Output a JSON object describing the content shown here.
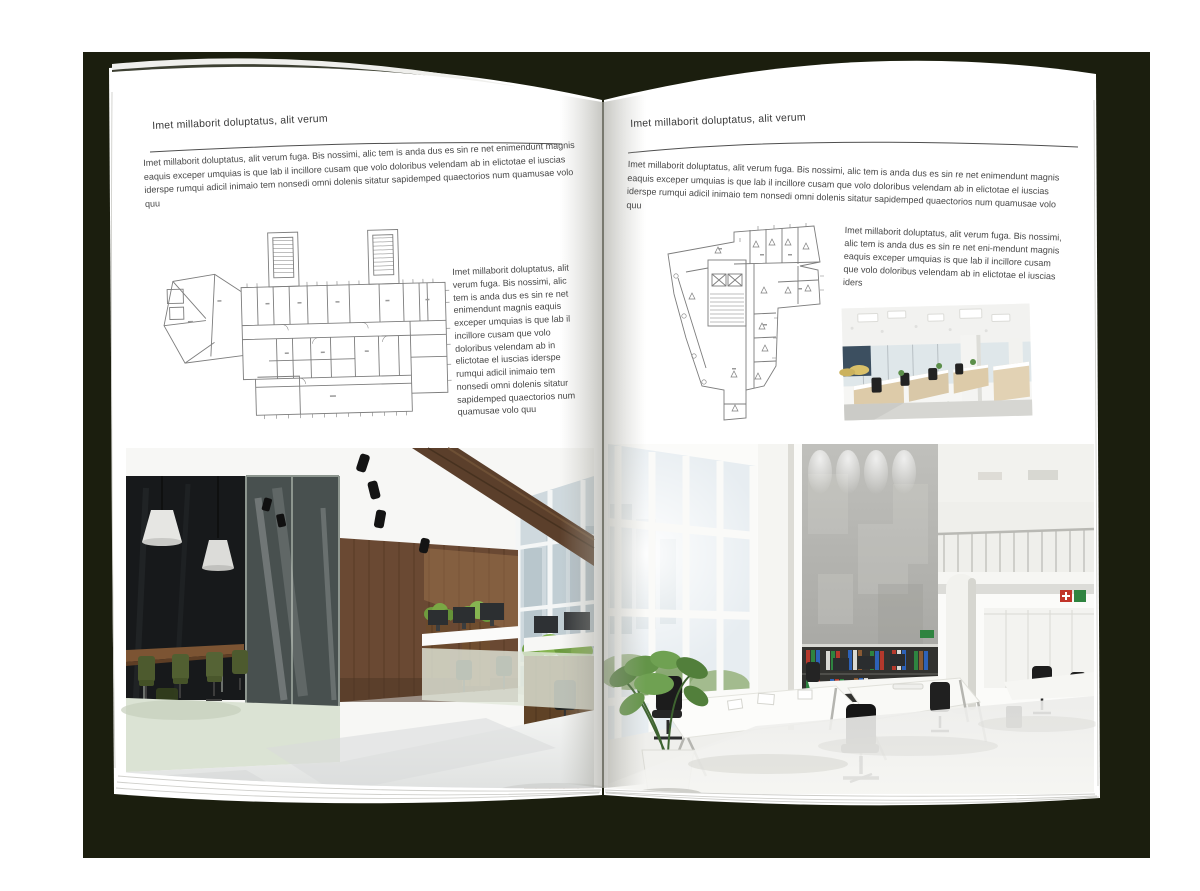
{
  "book": {
    "backdrop_color": "#1b1e0e",
    "page_color": "#ffffff",
    "text_color": "#3f3f3f"
  },
  "left_page": {
    "header": "Imet millaborit doluptatus, alit verum",
    "intro": "Imet millaborit doluptatus, alit verum fuga. Bis nossimi, alic tem is anda dus es sin re net enimendunt magnis eaquis exceper umquias is que lab il incillore cusam que volo doloribus velendam ab in elictotae el iuscias iderspe rumqui adicil inimaio tem nonsedi omni dolenis sitatur sapidemped quaectorios num quamusae volo quu",
    "caption": "Imet millaborit doluptatus, alit verum fuga. Bis nossimi, alic tem is anda dus es sin re net enimendunt magnis eaquis exceper umquias is que lab il incillore cusam que volo doloribus velendam ab in elictotae el iuscias iderspe rumqui adicil inimaio tem nonsedi omni dolenis sitatur sapidemped quaectorios num quamusae volo quu"
  },
  "right_page": {
    "header": "Imet millaborit doluptatus, alit verum",
    "intro": "Imet millaborit doluptatus, alit verum fuga. Bis nossimi, alic tem is anda dus es sin re net enimendunt magnis eaquis exceper umquias is que lab il incillore cusam que volo doloribus velendam ab in elictotae el iuscias iderspe rumqui adicil inimaio tem nonsedi omni dolenis sitatur sapidemped quaectorios num quamusae volo quu",
    "caption": "Imet millaborit doluptatus, alit verum fuga. Bis nossimi, alic tem is anda dus es sin re net eni-mendunt magnis eaquis exceper umquias is que lab il incillore cusam que volo doloribus velendam ab in elictotae el iuscias iders"
  }
}
